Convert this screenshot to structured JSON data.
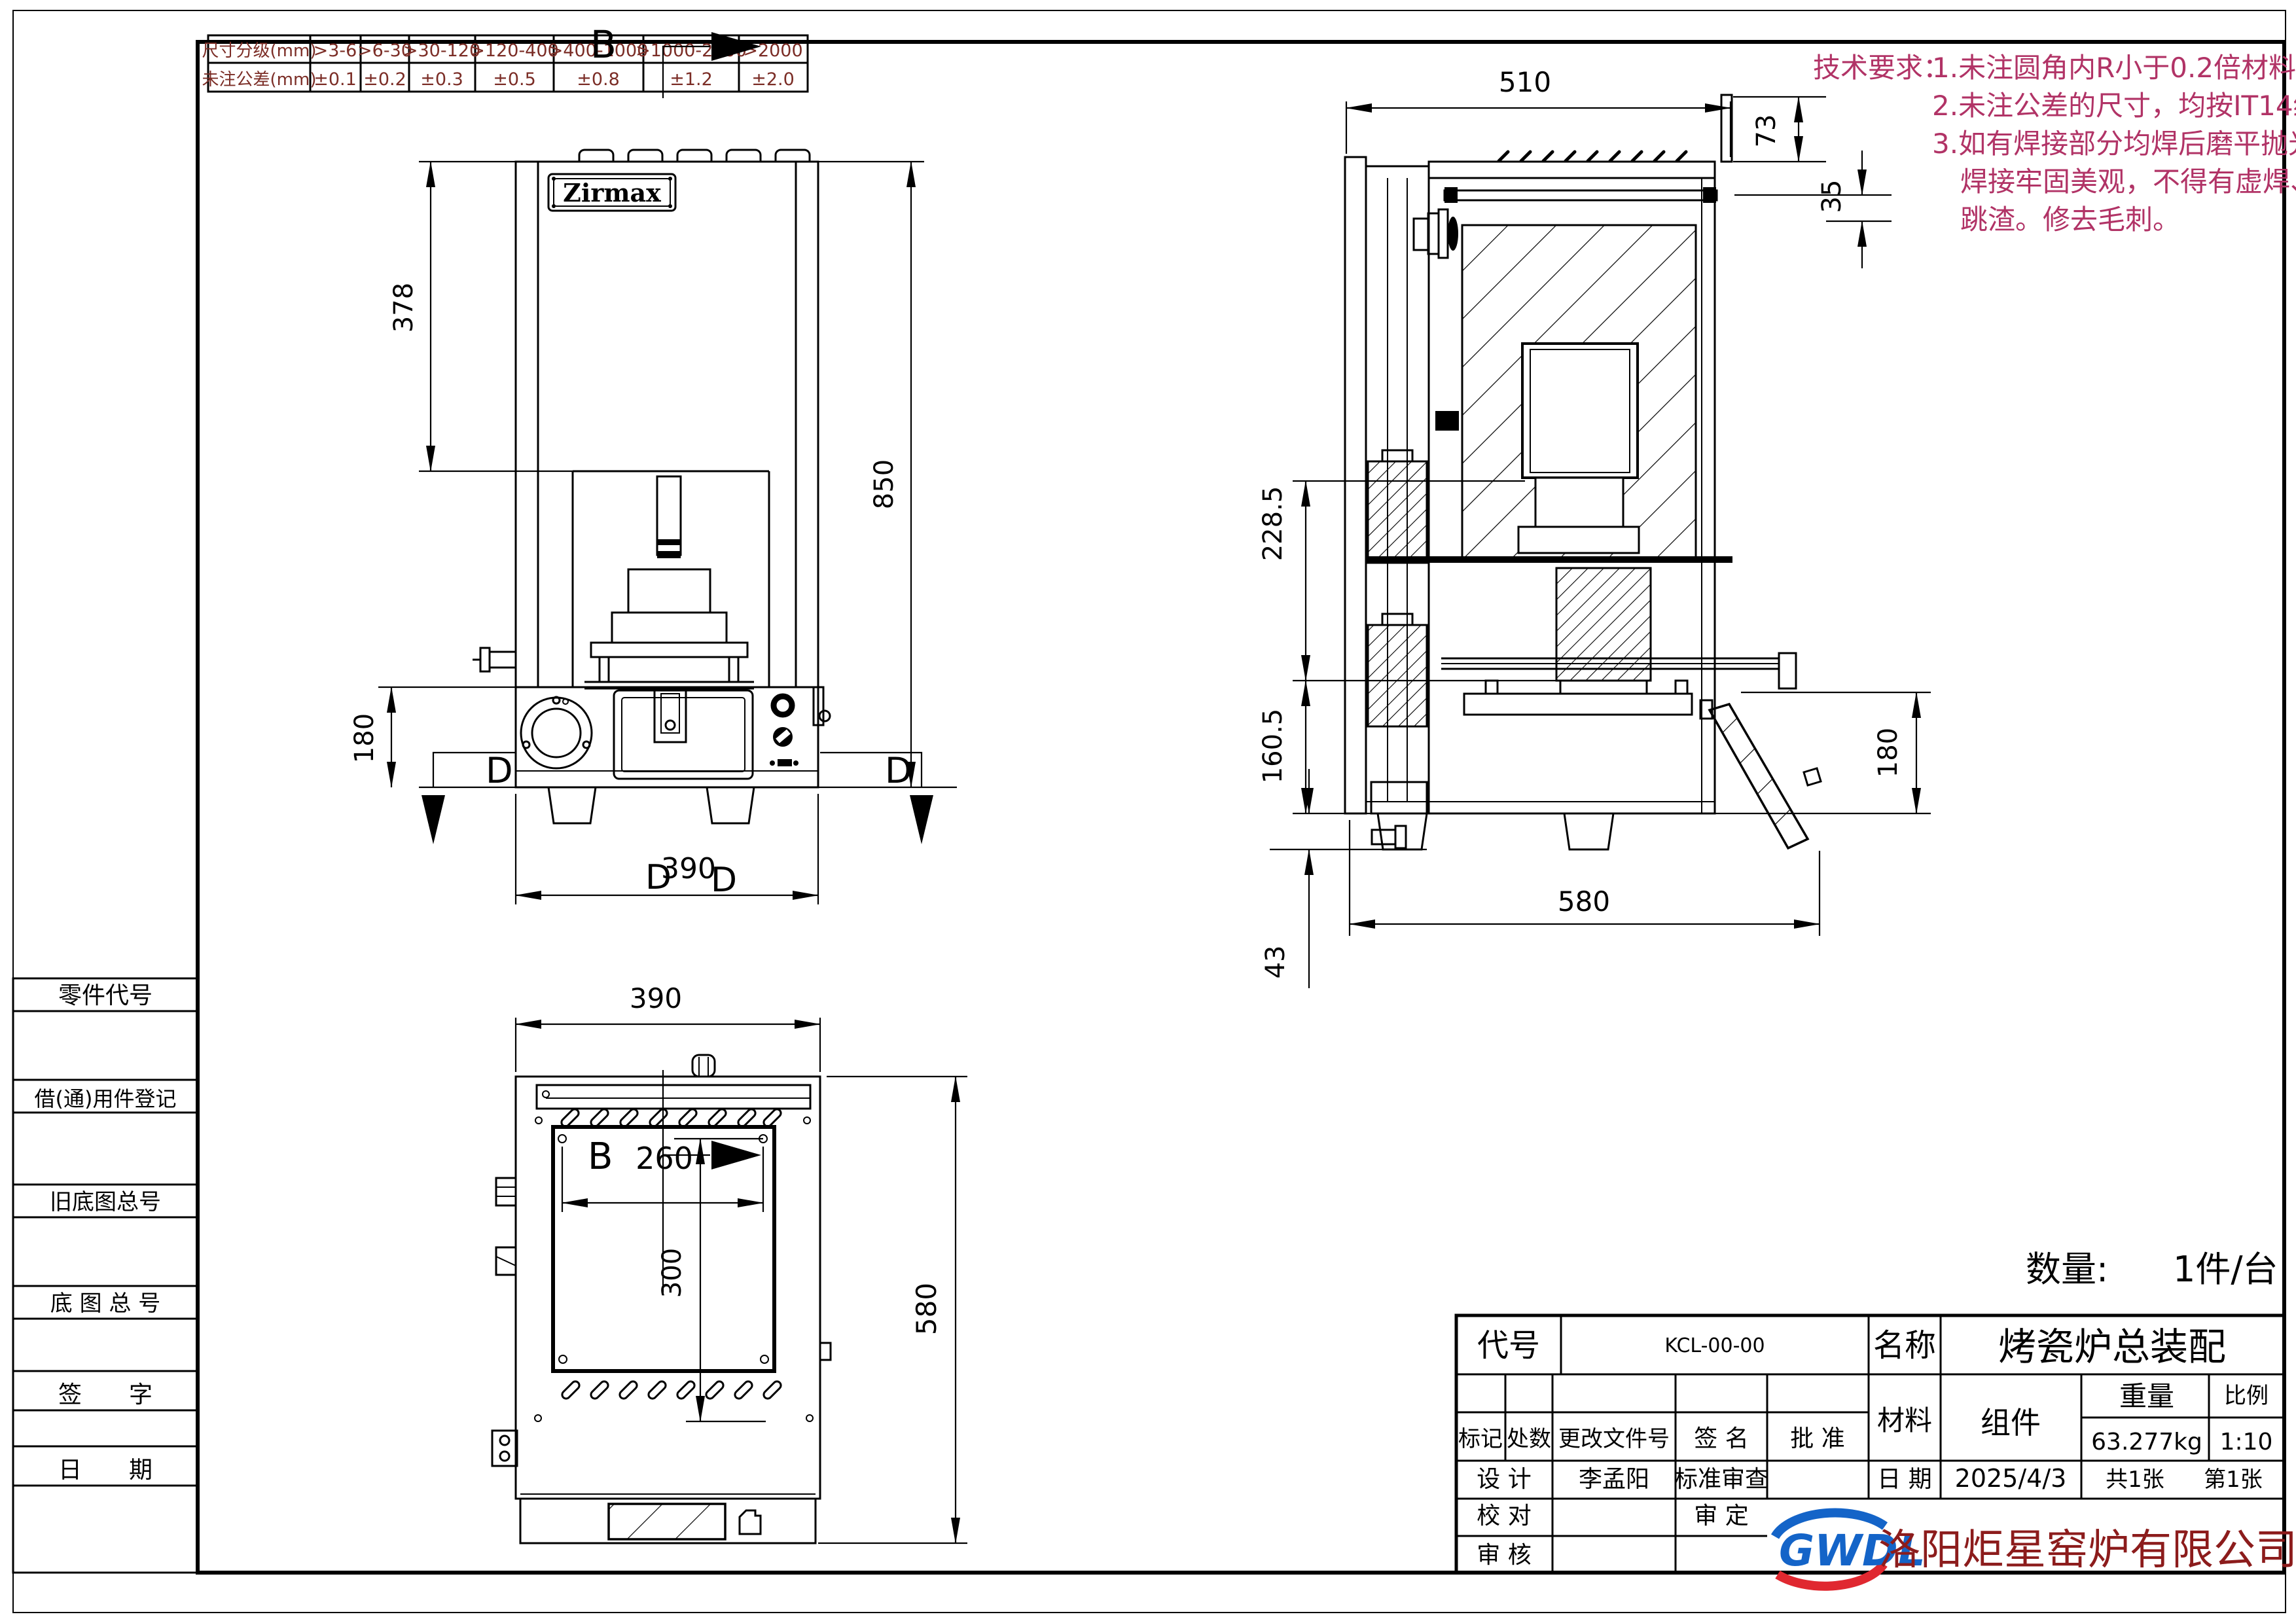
{
  "colors": {
    "line_black": "#000000",
    "tolerance_text": "#7b2d26",
    "tech_requirements_text": "#b13366",
    "company_text": "#8c1c1c",
    "logo_blue": "#1464c8",
    "logo_red": "#e02830"
  },
  "tol": {
    "row1_label": "尺寸分级(mm)",
    "row2_label": "未注公差(mm)",
    "ranges": [
      ">3-6",
      ">6-30",
      ">30-120",
      ">120-400",
      ">400-1000",
      ">1000-2000",
      ">2000"
    ],
    "values": [
      "±0.1",
      "±0.2",
      "±0.3",
      "±0.5",
      "±0.8",
      "±1.2",
      "±2.0"
    ]
  },
  "tech": {
    "title": "技术要求：",
    "lines": [
      "1.未注圆角内R小于0.2倍材料厚度。",
      "2.未注公差的尺寸，均按IT14级！",
      "3.如有焊接部分均焊后磨平抛光，",
      "焊接牢固美观，不得有虚焊、",
      "跳渣。修去毛刺。"
    ]
  },
  "left_panel": {
    "items": [
      "零件代号",
      "借(通)用件登记",
      "旧底图总号",
      "底 图 总 号",
      "签　　字",
      "日　　期"
    ]
  },
  "qty": {
    "label": "数量:",
    "value": "1件/台"
  },
  "front": {
    "brand": "Zirmax",
    "dim_378": "378",
    "dim_850": "850",
    "dim_180": "180",
    "dim_390": "390",
    "label_b": "B",
    "label_d": "D"
  },
  "side": {
    "dim_510": "510",
    "dim_73": "73",
    "dim_35": "35",
    "dim_228_5": "228.5",
    "dim_160_5": "160.5",
    "dim_43": "43",
    "dim_580": "580",
    "dim_180": "180"
  },
  "bottom": {
    "dim_390": "390",
    "dim_260": "260",
    "dim_300": "300",
    "dim_580": "580",
    "label_b": "B"
  },
  "tb": {
    "daihao_label": "代号",
    "daihao_value": "KCL-00-00",
    "mingcheng_label": "名称",
    "mingcheng_value": "烤瓷炉总装配",
    "biaoji": "标记",
    "chushu": "处数",
    "genggai": "更改文件号",
    "qianming": "签  名",
    "pizhun": "批  准",
    "cailiao": "材料",
    "zujian": "组件",
    "zhongliang_label": "重量",
    "zhongliang_value": "63.277kg",
    "bili_label": "比例",
    "bili_value": "1:10",
    "sheji": "设  计",
    "sheji_name": "李孟阳",
    "biaozhun_shencha": "标准审查",
    "riqi_label": "日  期",
    "riqi_value": "2025/4/3",
    "sheets_total": "共1张",
    "sheet_no": "第1张",
    "jiaodui": "校  对",
    "shending": "审  定",
    "shenhe": "审  核",
    "logo": "GWDL",
    "company": "洛阳炬星窑炉有限公司"
  }
}
